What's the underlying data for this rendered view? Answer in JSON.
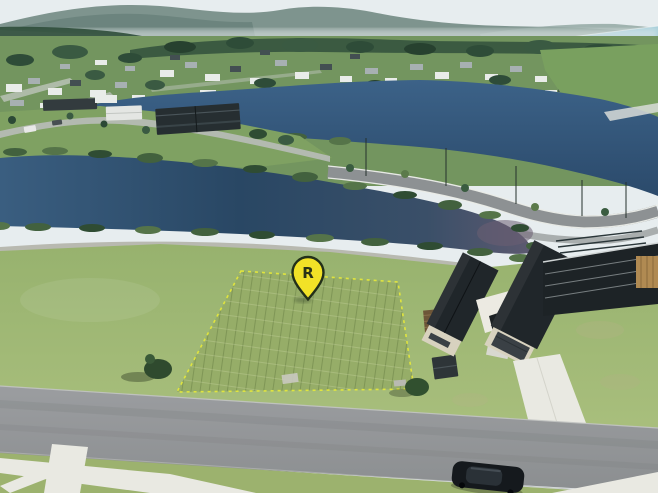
{
  "marker": {
    "label": "R"
  },
  "palette": {
    "sky": "#e7edef",
    "hills-far": "#7e948e",
    "hills-near": "#68817b",
    "mist": "#e9efef",
    "ocean": "#8fbccc",
    "estuary": "#ced3d0",
    "town-green": "#73955f",
    "tree-dark": "#2e4c38",
    "house-white": "#e9ece9",
    "house-gray": "#a7b0b2",
    "house-dark": "#434f52",
    "lake-upper": "#35597c",
    "lake-near": "#2e4c68",
    "lake-east": "#6b5f72",
    "shrub": "#42613e",
    "road": "#95979a",
    "road-line": "#eceee9",
    "path-bank": "#b3b2a8",
    "field": "#9eb773",
    "lot": "#96ad68",
    "lot-line": "#e8ea3a",
    "roof": "#20262a",
    "wall": "#d8d2bf",
    "garage": "#3a4045",
    "concrete": "#e9e9e2",
    "street": "#97999b",
    "verge": "#9cb26e",
    "car": "#15191d",
    "construction": "#1d2326",
    "timber": "#b08a52",
    "pin-fill": "#f2e227",
    "pin-outline": "#233019",
    "pin-letter": "#2a3317"
  }
}
